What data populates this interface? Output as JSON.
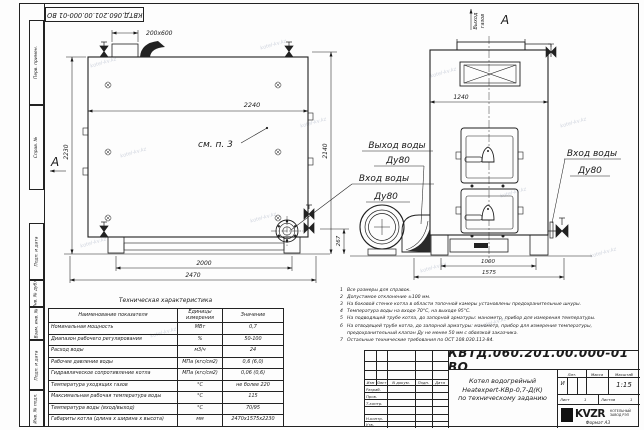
{
  "stamp_top": "КВТД.060.201.00.000-01 ВО",
  "watermark": {
    "text": "kotel-kv.kz"
  },
  "sidebar": {
    "items": [
      "Перв. примен.",
      "Справ. №",
      "Подп. и дата",
      "Инв. № дубл.",
      "Взам. инв. №",
      "Подп. и дата",
      "Инв. № подл."
    ]
  },
  "drawing": {
    "view_arrow": "А",
    "view_label": "А",
    "gas1": "Выход",
    "gas2": "газов",
    "see_note": "см. п. 3",
    "labels": {
      "outlet": {
        "line1": "Выход воды",
        "line2": "Ду80"
      },
      "inlet_front": {
        "line1": "Вход воды",
        "line2": "Ду80"
      },
      "inlet_side": {
        "line1": "Вход воды",
        "line2": "Ду80"
      }
    },
    "dims": {
      "nozzle": "200x600",
      "front_width": "2240",
      "front_height": "2230",
      "mid_height": "2140",
      "outlet_height": "267",
      "base_width": "2000",
      "total_width": "2470",
      "side_width": "1240",
      "side_base": "1000",
      "side_total": "1575"
    }
  },
  "tech_table": {
    "title": "Техническая характеристика",
    "headers": [
      "Наименование показателя",
      "Единицы измерения",
      "Значение"
    ],
    "rows": [
      [
        "Номинальная мощность",
        "МВт",
        "0,7"
      ],
      [
        "Диапазон рабочего регулирования",
        "%",
        "50-100"
      ],
      [
        "Расход воды",
        "м3/ч",
        "24"
      ],
      [
        "Рабочее давление воды",
        "МПа (кгс/см2)",
        "0,6 (6,0)"
      ],
      [
        "Гидравлическое сопротивление котла",
        "МПа (кгс/см2)",
        "0,06 (0,6)"
      ],
      [
        "Температура уходящих газов",
        "°С",
        "не более 220"
      ],
      [
        "Максимальная рабочая температура воды",
        "°С",
        "115"
      ],
      [
        "Температура воды (вход/выход)",
        "°С",
        "70/95"
      ],
      [
        "Габариты котла (длина х ширина х высота)",
        "мм",
        "2470х1575х2230"
      ]
    ]
  },
  "notes": {
    "items": [
      {
        "n": "1",
        "text": "Все размеры для справок."
      },
      {
        "n": "2",
        "text": "Допустимое отклонение ±100 мм."
      },
      {
        "n": "3",
        "text": "На боковой стенке котла в области топочной камеры установлены предохранительные шнуры."
      },
      {
        "n": "4",
        "text": "Температура воды на входе 70°С, на выходе 95°С."
      },
      {
        "n": "5",
        "text": "На подводящей трубе котла, до запорной арматуры: манометр, прибор для измерения температуры."
      },
      {
        "n": "6",
        "text": "На отводящей трубе котла, до запорной арматуры: манометр, прибор для измерения температуры, предохранительный клапан Ду не менее 50 мм с обвязкой заказчика."
      },
      {
        "n": "7",
        "text": "Остальные технические требования по ОСТ 108.030.113-84."
      }
    ]
  },
  "title_block": {
    "doc_number": "КВТД.060.201.00.000-01 ВО",
    "cols": {
      "izm": "Изм",
      "list": "Лист",
      "ndoc": "N докум.",
      "podp": "Подп.",
      "data": "Дата"
    },
    "rows": {
      "razrab": "Разраб.",
      "prov": "Пров.",
      "tkontr": "Т.контр.",
      "nkontr": "Н.контр.",
      "utv": "Утв."
    },
    "product": {
      "line1": "Котел водогрейный",
      "line2": "Heatexpert-КВр-0,7-Д(К)",
      "line3": "по техническому заданию"
    },
    "lit_header": "Лит.",
    "mass_header": "Масса",
    "scale_header": "Масштаб",
    "lit": "И",
    "scale": "1:15",
    "sheet_label": "Лист",
    "sheet": "1",
    "sheets_label": "Листов",
    "sheets": "1",
    "logo": "KVZR",
    "logo_sub1": "КОТЕЛЬНЫЙ",
    "logo_sub2": "ЗАВОД РЭП",
    "format": "Формат А3"
  }
}
